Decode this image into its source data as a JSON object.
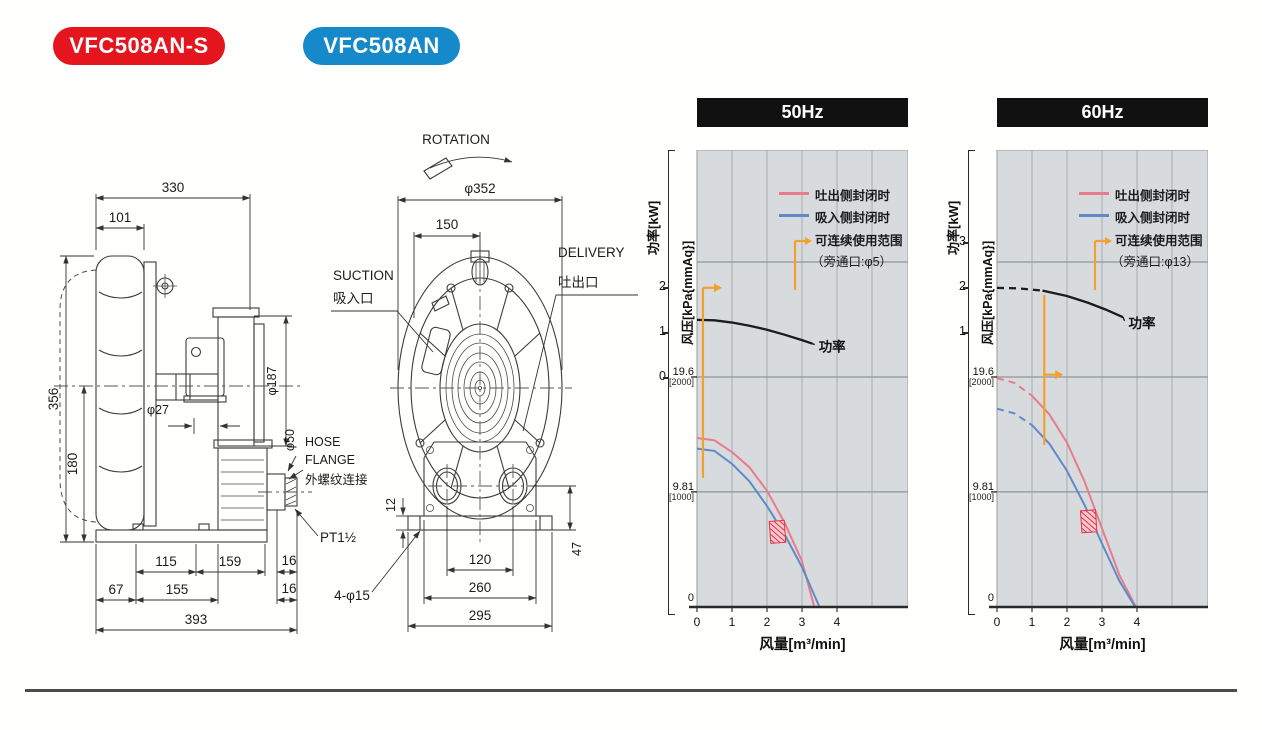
{
  "badges": [
    {
      "label": "VFC508AN-S",
      "color": "#e5151d"
    },
    {
      "label": "VFC508AN",
      "color": "#1689ca"
    }
  ],
  "drawing": {
    "side": {
      "dim_330": "330",
      "dim_101": "101",
      "dim_356": "356",
      "dim_180": "180",
      "dim_phi27": "φ27",
      "dim_phi187": "φ187",
      "dim_phi50": "φ50",
      "hose_line1": "HOSE",
      "hose_line2": "FLANGE",
      "hose_line3": "外螺纹连接",
      "pt_label": "PT1½",
      "dim_115": "115",
      "dim_159": "159",
      "dim_16a": "16",
      "dim_67": "67",
      "dim_155": "155",
      "dim_16b": "16",
      "dim_393": "393"
    },
    "front": {
      "rotation": "ROTATION",
      "dim_phi352": "φ352",
      "dim_150": "150",
      "suction_en": "SUCTION",
      "suction_cn": "吸入口",
      "delivery_en": "DELIVERY",
      "delivery_cn": "吐出口",
      "dim_12": "12",
      "dim_47": "47",
      "dim_120": "120",
      "dim_260": "260",
      "dim_295": "295",
      "dim_4phi15": "4-φ15"
    }
  },
  "chart_data": [
    {
      "type": "line",
      "title": "50Hz",
      "xlabel": "风量[m³/min]",
      "ylabel_power": "功率[kW]",
      "ylabel_pressure": "风压[kPa{mmAq}]",
      "xlim": [
        0,
        6
      ],
      "x_ticks": [
        0,
        1,
        2,
        3,
        4
      ],
      "power_ticks": [
        2,
        1,
        0
      ],
      "pressure_ticks": [
        {
          "kpa": "19.6",
          "mmaq": "[2000]",
          "p": 19.6
        },
        {
          "kpa": "9.81",
          "mmaq": "[1000]",
          "p": 9.81
        },
        {
          "kpa": "0",
          "mmaq": "",
          "p": 0
        }
      ],
      "legend": [
        {
          "label": "吐出侧封闭时",
          "color": "#e87c8d",
          "type": "line"
        },
        {
          "label": "吸入侧封闭时",
          "color": "#6089c8",
          "type": "line"
        },
        {
          "label": "可连续使用范围",
          "label2": "（旁通口:φ5）",
          "color": "#f2a12f",
          "type": "range"
        }
      ],
      "series": [
        {
          "name": "功率",
          "axis": "power",
          "color": "#1c1c1c",
          "points": [
            [
              0,
              1.27
            ],
            [
              0.5,
              1.26
            ],
            [
              1,
              1.21
            ],
            [
              1.5,
              1.14
            ],
            [
              2,
              1.05
            ],
            [
              2.5,
              0.94
            ],
            [
              3,
              0.82
            ],
            [
              3.3,
              0.74
            ]
          ]
        },
        {
          "name": "吐出侧封闭时",
          "axis": "pressure",
          "color": "#e87c8d",
          "points": [
            [
              0,
              14.4
            ],
            [
              0.5,
              14.2
            ],
            [
              1,
              13.2
            ],
            [
              1.5,
              11.9
            ],
            [
              2,
              9.9
            ],
            [
              2.5,
              7.2
            ],
            [
              3,
              3.9
            ],
            [
              3.35,
              0
            ]
          ]
        },
        {
          "name": "吸入侧封闭时",
          "axis": "pressure",
          "color": "#6089c8",
          "points": [
            [
              0,
              13.5
            ],
            [
              0.5,
              13.3
            ],
            [
              1,
              12.2
            ],
            [
              1.5,
              10.7
            ],
            [
              2,
              8.6
            ],
            [
              2.5,
              6.2
            ],
            [
              3,
              3.4
            ],
            [
              3.5,
              0
            ]
          ]
        }
      ],
      "power_label": {
        "text": "功率",
        "x": 3.42,
        "kw": 0.63
      },
      "range_marker": {
        "x": 0.17,
        "p_from": 11.0,
        "p_to": 27.2,
        "arrow_p": 27.2
      },
      "hatch_marker": {
        "x": 2.3,
        "p": 6.4
      }
    },
    {
      "type": "line",
      "title": "60Hz",
      "xlabel": "风量[m³/min]",
      "ylabel_power": "功率[kW]",
      "ylabel_pressure": "风压[kPa{mmAq}]",
      "xlim": [
        0,
        6
      ],
      "x_ticks": [
        0,
        1,
        2,
        3,
        4
      ],
      "power_ticks": [
        3,
        2,
        1
      ],
      "pressure_ticks": [
        {
          "kpa": "19.6",
          "mmaq": "[2000]",
          "p": 19.6
        },
        {
          "kpa": "9.81",
          "mmaq": "[1000]",
          "p": 9.81
        },
        {
          "kpa": "0",
          "mmaq": "",
          "p": 0
        }
      ],
      "legend": [
        {
          "label": "吐出侧封闭时",
          "color": "#e87c8d",
          "type": "line"
        },
        {
          "label": "吸入侧封闭时",
          "color": "#6089c8",
          "type": "line"
        },
        {
          "label": "可连续使用范围",
          "label2": "（旁通口:φ13）",
          "color": "#f2a12f",
          "type": "range"
        }
      ],
      "series": [
        {
          "name": "功率",
          "axis": "power",
          "color": "#1c1c1c",
          "dash_until": 1.3,
          "points": [
            [
              0,
              1.98
            ],
            [
              0.6,
              1.97
            ],
            [
              1.3,
              1.92
            ],
            [
              2,
              1.8
            ],
            [
              2.6,
              1.65
            ],
            [
              3.1,
              1.5
            ],
            [
              3.6,
              1.33
            ]
          ]
        },
        {
          "name": "吐出侧封闭时",
          "axis": "pressure",
          "color": "#e87c8d",
          "dash_until": 1.0,
          "points": [
            [
              0,
              19.5
            ],
            [
              0.5,
              19.1
            ],
            [
              1,
              18.0
            ],
            [
              1.5,
              16.4
            ],
            [
              2,
              14.0
            ],
            [
              2.5,
              10.7
            ],
            [
              3,
              6.7
            ],
            [
              3.5,
              2.7
            ],
            [
              3.97,
              0
            ]
          ]
        },
        {
          "name": "吸入侧封闭时",
          "axis": "pressure",
          "color": "#6089c8",
          "dash_until": 1.0,
          "points": [
            [
              0,
              16.9
            ],
            [
              0.5,
              16.5
            ],
            [
              1,
              15.5
            ],
            [
              1.5,
              13.9
            ],
            [
              2,
              11.6
            ],
            [
              2.5,
              8.7
            ],
            [
              3,
              5.4
            ],
            [
              3.5,
              2.2
            ],
            [
              3.95,
              0
            ]
          ]
        }
      ],
      "power_label": {
        "text": "功率",
        "x": 3.7,
        "kw": 1.16
      },
      "range_marker": {
        "x": 1.35,
        "p_from": 13.8,
        "p_to": 26.6,
        "arrow_p": 19.8
      },
      "hatch_marker": {
        "x": 2.62,
        "p": 7.3
      }
    }
  ]
}
